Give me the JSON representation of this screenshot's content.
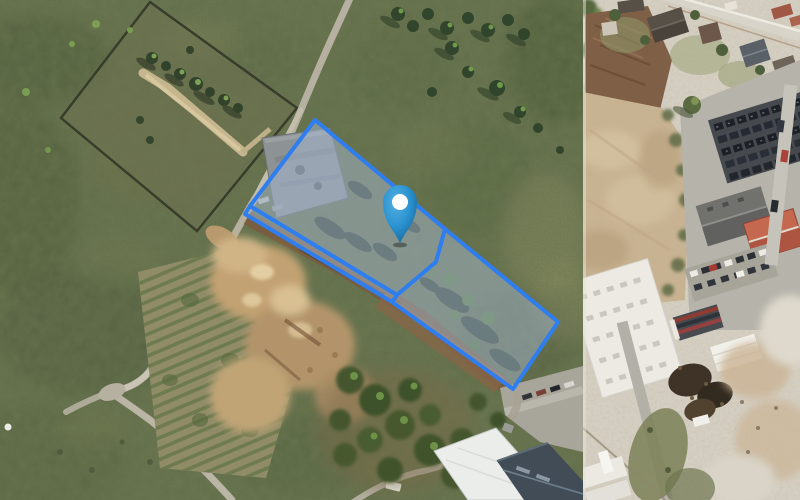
{
  "app": {
    "kind": "satellite-map-view",
    "visible_text": "none"
  },
  "map": {
    "view_mode": "aerial-imagery",
    "tile_seam_x": 583,
    "colors": {
      "parcel_stroke": "#2e7ef0",
      "parcel_fill": "rgba(168,186,214,0.48)",
      "pin_blue": "#2b93d1",
      "pin_blue_dark": "#176a9e",
      "pin_dot": "#ffffff"
    }
  },
  "overlay": {
    "stroke_width": 4,
    "parcels": [
      {
        "id": "parcel-boundary-main",
        "points": [
          [
            315,
            120
          ],
          [
            445,
            229
          ],
          [
            436,
            262
          ],
          [
            397,
            295
          ],
          [
            250,
            206
          ]
        ]
      },
      {
        "id": "parcel-boundary-east",
        "points": [
          [
            445,
            229
          ],
          [
            558,
            322
          ],
          [
            513,
            389
          ],
          [
            392,
            302
          ],
          [
            397,
            295
          ],
          [
            436,
            262
          ]
        ]
      },
      {
        "id": "parcel-boundary-road-strip",
        "points": [
          [
            250,
            206
          ],
          [
            397,
            295
          ],
          [
            392,
            302
          ],
          [
            245,
            214
          ]
        ]
      }
    ],
    "marker": {
      "tip_x": 400,
      "tip_y": 243,
      "head_cx": 400,
      "head_cy": 202,
      "head_r": 17,
      "dot_r": 8
    }
  }
}
